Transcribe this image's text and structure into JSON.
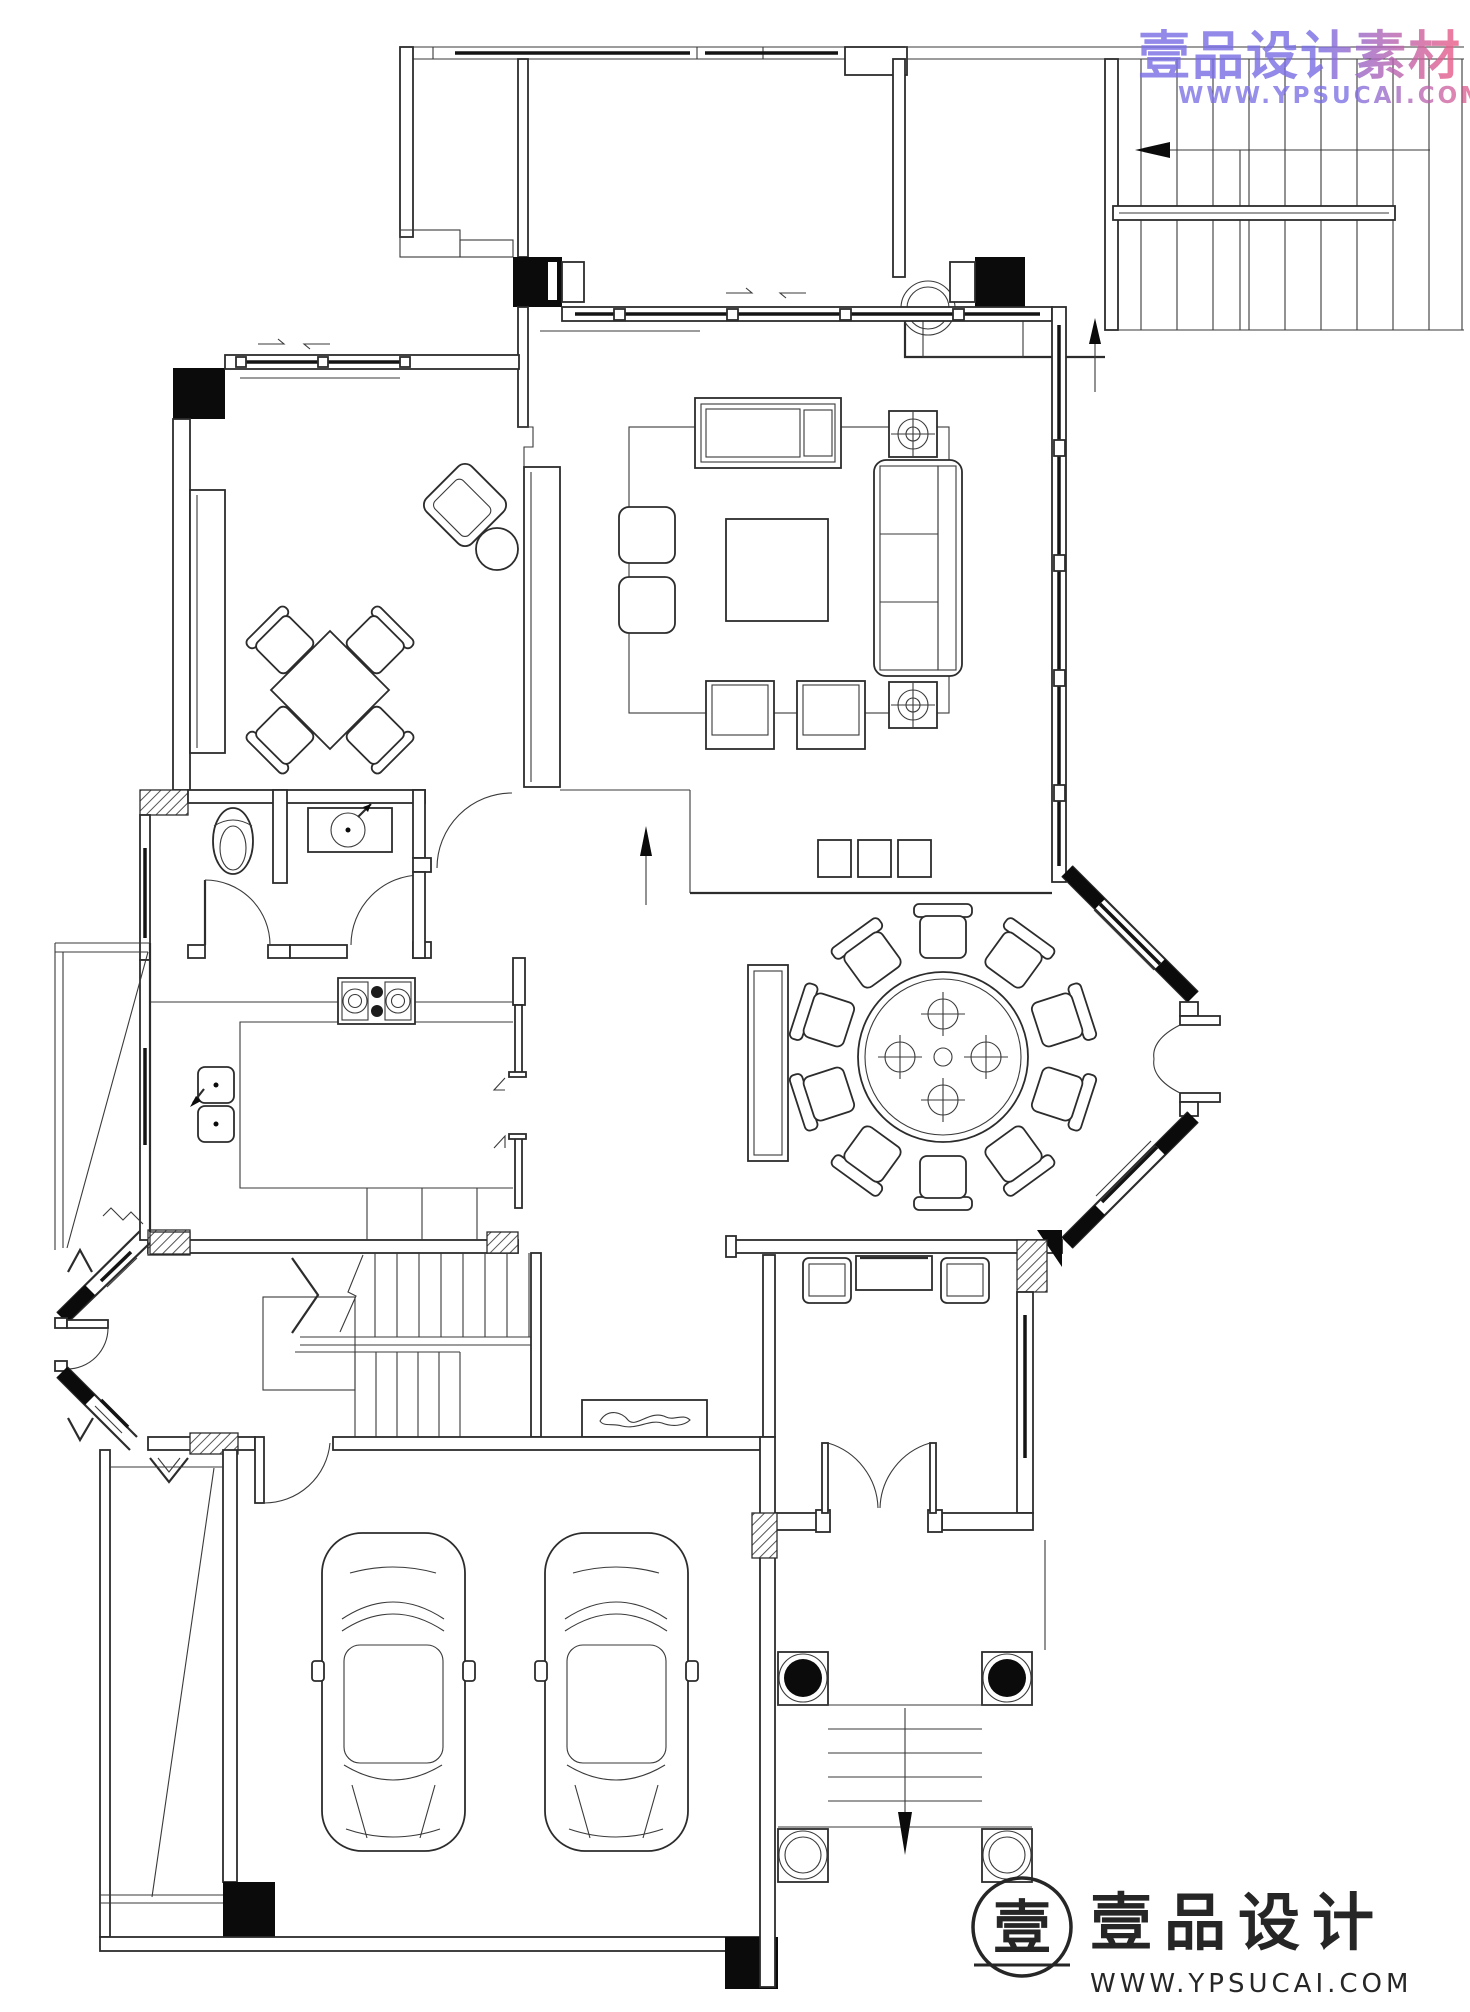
{
  "watermark_top": {
    "text": "壹品设计素材",
    "url": "WWW.YPSUCAI.COM",
    "gradient_start": "#7b70e4",
    "gradient_end": "#ef5f86"
  },
  "brand_logo": {
    "symbol": "壹",
    "name": "壹品设计",
    "url": "WWW.YPSUCAI.COM",
    "ink": "#262626"
  },
  "plan": {
    "background": "#ffffff",
    "line_color": "#2c2c2c",
    "wall_fill": "#0b0b0b",
    "areas": [
      "roof-terrace",
      "exterior-staircase",
      "living-room",
      "tea-room",
      "bathroom",
      "kitchen",
      "dining-room",
      "stair-hall",
      "entry-hall",
      "entry-porch",
      "double-garage",
      "side-yard",
      "west-bay-entry",
      "east-bay-window"
    ],
    "fixtures": [
      "daybed",
      "sofa",
      "coffee-table",
      "ottomans",
      "armchairs",
      "side-tables",
      "tv-cabinet",
      "square-tea-table",
      "tea-chairs",
      "rotated-armchair",
      "round-side-table",
      "toilet",
      "wash-basin",
      "vanity-counter",
      "gas-stove",
      "double-sink",
      "round-dining-table",
      "lazy-susan",
      "dining-chairs",
      "sideboard",
      "console-table",
      "hall-chairs",
      "shoe-cabinet",
      "entry-double-door",
      "porch-columns",
      "entry-steps",
      "car",
      "car"
    ]
  }
}
